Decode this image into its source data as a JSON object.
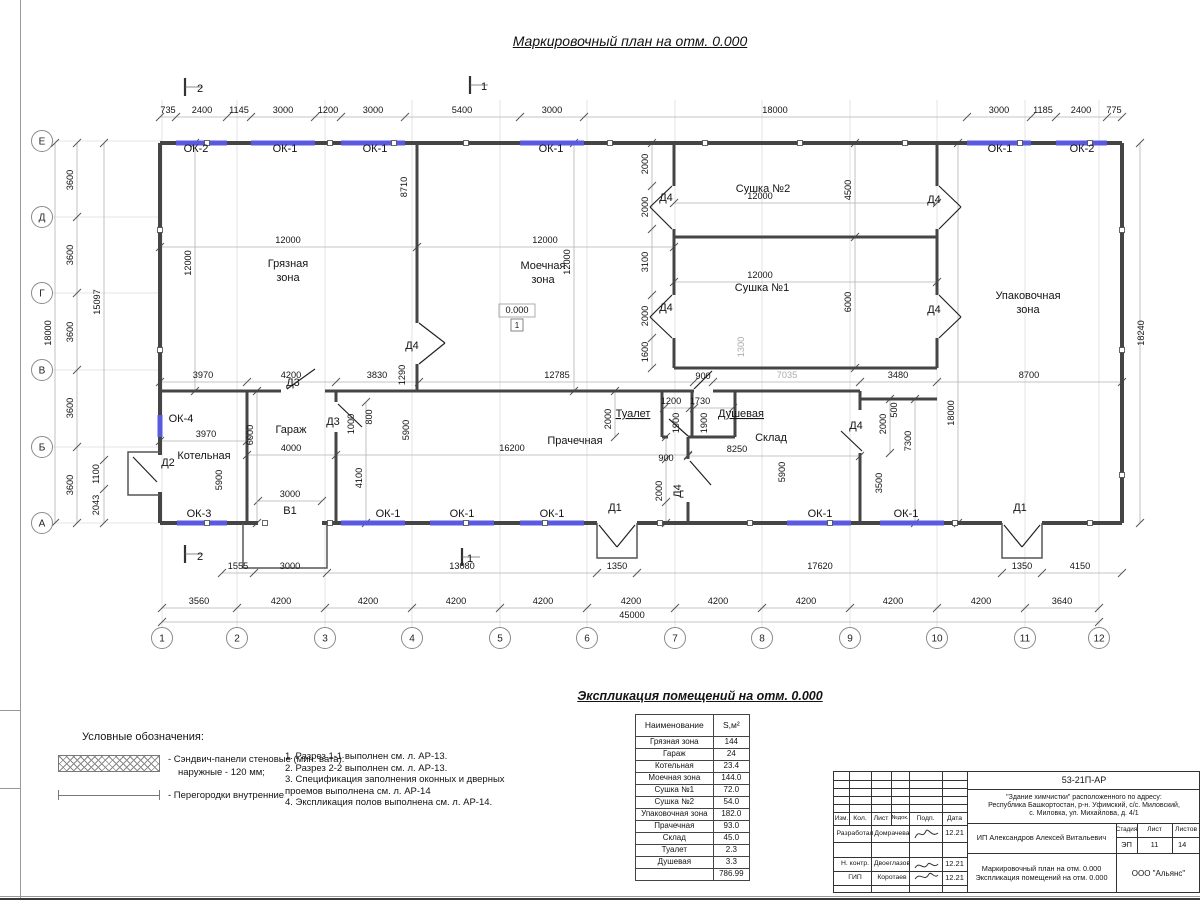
{
  "title": "Маркировочный план на отм. 0.000",
  "plan": {
    "texts": [
      [
        168,
        113,
        "735"
      ],
      [
        202,
        113,
        "2400"
      ],
      [
        239,
        113,
        "1145"
      ],
      [
        283,
        113,
        "3000"
      ],
      [
        328,
        113,
        "1200"
      ],
      [
        373,
        113,
        "3000"
      ],
      [
        462,
        113,
        "5400"
      ],
      [
        552,
        113,
        "3000"
      ],
      [
        775,
        113,
        "18000"
      ],
      [
        999,
        113,
        "3000"
      ],
      [
        1043,
        113,
        "1185"
      ],
      [
        1081,
        113,
        "2400"
      ],
      [
        1114,
        113,
        "775"
      ],
      [
        51,
        333,
        "18000",
        "r"
      ],
      [
        73,
        180,
        "3600",
        "r"
      ],
      [
        73,
        255,
        "3600",
        "r"
      ],
      [
        73,
        332,
        "3600",
        "r"
      ],
      [
        73,
        408,
        "3600",
        "r"
      ],
      [
        73,
        485,
        "3600",
        "r"
      ],
      [
        100,
        302,
        "15097",
        "r"
      ],
      [
        99,
        474,
        "1100",
        "r"
      ],
      [
        99,
        505,
        "2043",
        "r"
      ],
      [
        1144,
        333,
        "18240",
        "r"
      ],
      [
        238,
        569,
        "1555"
      ],
      [
        290,
        569,
        "3000"
      ],
      [
        462,
        569,
        "13080"
      ],
      [
        617,
        569,
        "1350"
      ],
      [
        820,
        569,
        "17620"
      ],
      [
        1022,
        569,
        "1350"
      ],
      [
        1080,
        569,
        "4150"
      ],
      [
        199,
        604,
        "3560"
      ],
      [
        281,
        604,
        "4200"
      ],
      [
        368,
        604,
        "4200"
      ],
      [
        456,
        604,
        "4200"
      ],
      [
        543,
        604,
        "4200"
      ],
      [
        631,
        604,
        "4200"
      ],
      [
        718,
        604,
        "4200"
      ],
      [
        806,
        604,
        "4200"
      ],
      [
        893,
        604,
        "4200"
      ],
      [
        981,
        604,
        "4200"
      ],
      [
        1062,
        604,
        "3640"
      ],
      [
        632,
        618,
        "45000"
      ],
      [
        196,
        152,
        "ОК-2",
        "L"
      ],
      [
        285,
        152,
        "ОК-1",
        "L"
      ],
      [
        375,
        152,
        "ОК-1",
        "L"
      ],
      [
        551,
        152,
        "ОК-1",
        "L"
      ],
      [
        1000,
        152,
        "ОК-1",
        "L"
      ],
      [
        1082,
        152,
        "ОК-2",
        "L"
      ],
      [
        199,
        517,
        "ОК-3",
        "L"
      ],
      [
        388,
        517,
        "ОК-1",
        "L"
      ],
      [
        462,
        517,
        "ОК-1",
        "L"
      ],
      [
        552,
        517,
        "ОК-1",
        "L"
      ],
      [
        820,
        517,
        "ОК-1",
        "L"
      ],
      [
        906,
        517,
        "ОК-1",
        "L"
      ],
      [
        181,
        422,
        "ОК-4",
        "L"
      ],
      [
        288,
        267,
        "Грязная",
        "L"
      ],
      [
        288,
        281,
        "зона",
        "L"
      ],
      [
        543,
        269,
        "Моечная",
        "L"
      ],
      [
        543,
        283,
        "зона",
        "L"
      ],
      [
        763,
        192,
        "Сушка №2",
        "L"
      ],
      [
        762,
        291,
        "Сушка №1",
        "L"
      ],
      [
        1028,
        299,
        "Упаковочная",
        "L"
      ],
      [
        1028,
        313,
        "зона",
        "L"
      ],
      [
        204,
        459,
        "Котельная",
        "L"
      ],
      [
        291,
        433,
        "Гараж",
        "L"
      ],
      [
        575,
        444,
        "Прачечная",
        "L"
      ],
      [
        633,
        417,
        "Туалет",
        "Lu"
      ],
      [
        741,
        417,
        "Душевая",
        "Lu"
      ],
      [
        771,
        441,
        "Склад",
        "L"
      ],
      [
        517,
        313,
        "0.000"
      ],
      [
        517,
        328,
        "1",
        "s"
      ],
      [
        412,
        349,
        "Д4",
        "L"
      ],
      [
        666,
        201,
        "Д4",
        "L"
      ],
      [
        666,
        311,
        "Д4",
        "L"
      ],
      [
        934,
        203,
        "Д4",
        "L"
      ],
      [
        934,
        313,
        "Д4",
        "L"
      ],
      [
        856,
        429,
        "Д4",
        "L"
      ],
      [
        681,
        491,
        "Д4",
        "Lr"
      ],
      [
        293,
        386,
        "Д3",
        "L"
      ],
      [
        333,
        425,
        "Д3",
        "L"
      ],
      [
        168,
        466,
        "Д2",
        "L"
      ],
      [
        615,
        511,
        "Д1",
        "L"
      ],
      [
        1020,
        511,
        "Д1",
        "L"
      ],
      [
        288,
        243,
        "12000"
      ],
      [
        191,
        263,
        "12000",
        "r"
      ],
      [
        407,
        187,
        "8710",
        "r"
      ],
      [
        545,
        243,
        "12000"
      ],
      [
        570,
        262,
        "12000",
        "r"
      ],
      [
        405,
        375,
        "1290",
        "r"
      ],
      [
        760,
        199,
        "12000"
      ],
      [
        648,
        164,
        "2000",
        "r"
      ],
      [
        648,
        207,
        "2000",
        "r"
      ],
      [
        851,
        190,
        "4500",
        "r"
      ],
      [
        760,
        278,
        "12000"
      ],
      [
        648,
        262,
        "3100",
        "r"
      ],
      [
        648,
        316,
        "2000",
        "r"
      ],
      [
        648,
        352,
        "1600",
        "r"
      ],
      [
        851,
        302,
        "6000",
        "r"
      ],
      [
        744,
        347,
        "1300",
        "rg"
      ],
      [
        203,
        378,
        "3970"
      ],
      [
        291,
        378,
        "4200"
      ],
      [
        377,
        378,
        "3830"
      ],
      [
        557,
        378,
        "12785"
      ],
      [
        703,
        379,
        "900"
      ],
      [
        787,
        378,
        "7035",
        "g"
      ],
      [
        898,
        378,
        "3480"
      ],
      [
        1029,
        378,
        "8700"
      ],
      [
        206,
        437,
        "3970"
      ],
      [
        222,
        480,
        "5900",
        "r"
      ],
      [
        253,
        435,
        "6000",
        "r"
      ],
      [
        291,
        451,
        "4000"
      ],
      [
        290,
        497,
        "3000"
      ],
      [
        290,
        514,
        "В1",
        "L"
      ],
      [
        362,
        478,
        "4100",
        "r"
      ],
      [
        354,
        424,
        "1000",
        "r"
      ],
      [
        372,
        417,
        "800",
        "r"
      ],
      [
        512,
        451,
        "16200"
      ],
      [
        409,
        430,
        "5900",
        "r"
      ],
      [
        611,
        419,
        "2000",
        "r"
      ],
      [
        671,
        404,
        "1200"
      ],
      [
        700,
        404,
        "1730"
      ],
      [
        679,
        423,
        "1900",
        "r"
      ],
      [
        707,
        423,
        "1900",
        "r"
      ],
      [
        666,
        461,
        "900"
      ],
      [
        662,
        491,
        "2000",
        "r"
      ],
      [
        737,
        452,
        "8250"
      ],
      [
        785,
        472,
        "5900",
        "r"
      ],
      [
        886,
        424,
        "2000",
        "r"
      ],
      [
        897,
        410,
        "500",
        "r"
      ],
      [
        882,
        483,
        "3500",
        "r"
      ],
      [
        911,
        441,
        "7300",
        "r"
      ],
      [
        954,
        413,
        "18000",
        "r"
      ],
      [
        200,
        92,
        "2",
        "L"
      ],
      [
        484,
        90,
        "1",
        "L"
      ],
      [
        200,
        560,
        "2",
        "L"
      ],
      [
        470,
        562,
        "1",
        "L"
      ]
    ],
    "axes_bottom": [
      [
        "1",
        162
      ],
      [
        "2",
        237
      ],
      [
        "3",
        325
      ],
      [
        "4",
        412
      ],
      [
        "5",
        500
      ],
      [
        "6",
        587
      ],
      [
        "7",
        675
      ],
      [
        "8",
        762
      ],
      [
        "9",
        850
      ],
      [
        "10",
        937
      ],
      [
        "11",
        1025
      ],
      [
        "12",
        1099
      ]
    ],
    "axes_left": [
      [
        "Е",
        141
      ],
      [
        "Д",
        217
      ],
      [
        "Г",
        293
      ],
      [
        "В",
        370
      ],
      [
        "Б",
        447
      ],
      [
        "А",
        523
      ]
    ]
  },
  "schedule": {
    "title": "Экспликация помещений на отм. 0.000",
    "col_name": "Наименование",
    "col_area": "S,м²",
    "rows": [
      [
        "Грязная зона",
        "144"
      ],
      [
        "Гараж",
        "24"
      ],
      [
        "Котельная",
        "23.4"
      ],
      [
        "Моечная зона",
        "144.0"
      ],
      [
        "Сушка №1",
        "72.0"
      ],
      [
        "Сушка №2",
        "54.0"
      ],
      [
        "Упаковочная зона",
        "182.0"
      ],
      [
        "Прачечная",
        "93.0"
      ],
      [
        "Склад",
        "45.0"
      ],
      [
        "Туалет",
        "2.3"
      ],
      [
        "Душевая",
        "3.3"
      ]
    ],
    "total": "786.99"
  },
  "legend": {
    "title": "Условные обозначения:",
    "item1a": "- Сэндвич-панели стеновые (мин. вата):",
    "item1b": "наружные - 120 мм;",
    "item2": "- Перегородки внутренние"
  },
  "notes": {
    "lines": [
      "1. Разрез 1-1 выполнен см. л. АР-13.",
      "2. Разрез 2-2 выполнен см. л. АР-13.",
      "3. Спецификация заполнения оконных и дверных",
      "проемов выполнена см. л. АР-14",
      "4. Экспликация полов выполнена см. л. АР-14."
    ]
  },
  "titleblock": {
    "code": "53-21П-АР",
    "address1": "\"Здание химчистки\" расположенного по адресу:",
    "address2": "Республика Башкортостан, р-н. Уфимский, с/с. Миловский,",
    "address3": "с. Миловка, ул. Михайлова, д. 4/1",
    "h_izm": "Изм.",
    "h_kol": "Кол.",
    "h_list": "Лист",
    "h_ndok": "№док.",
    "h_podp": "Подп.",
    "h_data": "Дата",
    "rows": [
      {
        "role": "Разработал",
        "name": "Домрачева",
        "date": "12.21"
      },
      {
        "role": "Н. контр.",
        "name": "Двоеглазов",
        "date": "12.21"
      },
      {
        "role": "ГИП",
        "name": "Коротаев",
        "date": "12.21"
      }
    ],
    "client": "ИП Александров Алексей Витальевич",
    "stage_h": "Стадия",
    "sheet_h": "Лист",
    "sheets_h": "Листов",
    "stage": "ЭП",
    "sheet": "11",
    "sheets": "14",
    "doc1": "Маркировочный план на отм. 0.000",
    "doc2": "Экспликация помещений на отм. 0.000",
    "org": "ООО \"Альянс\""
  }
}
